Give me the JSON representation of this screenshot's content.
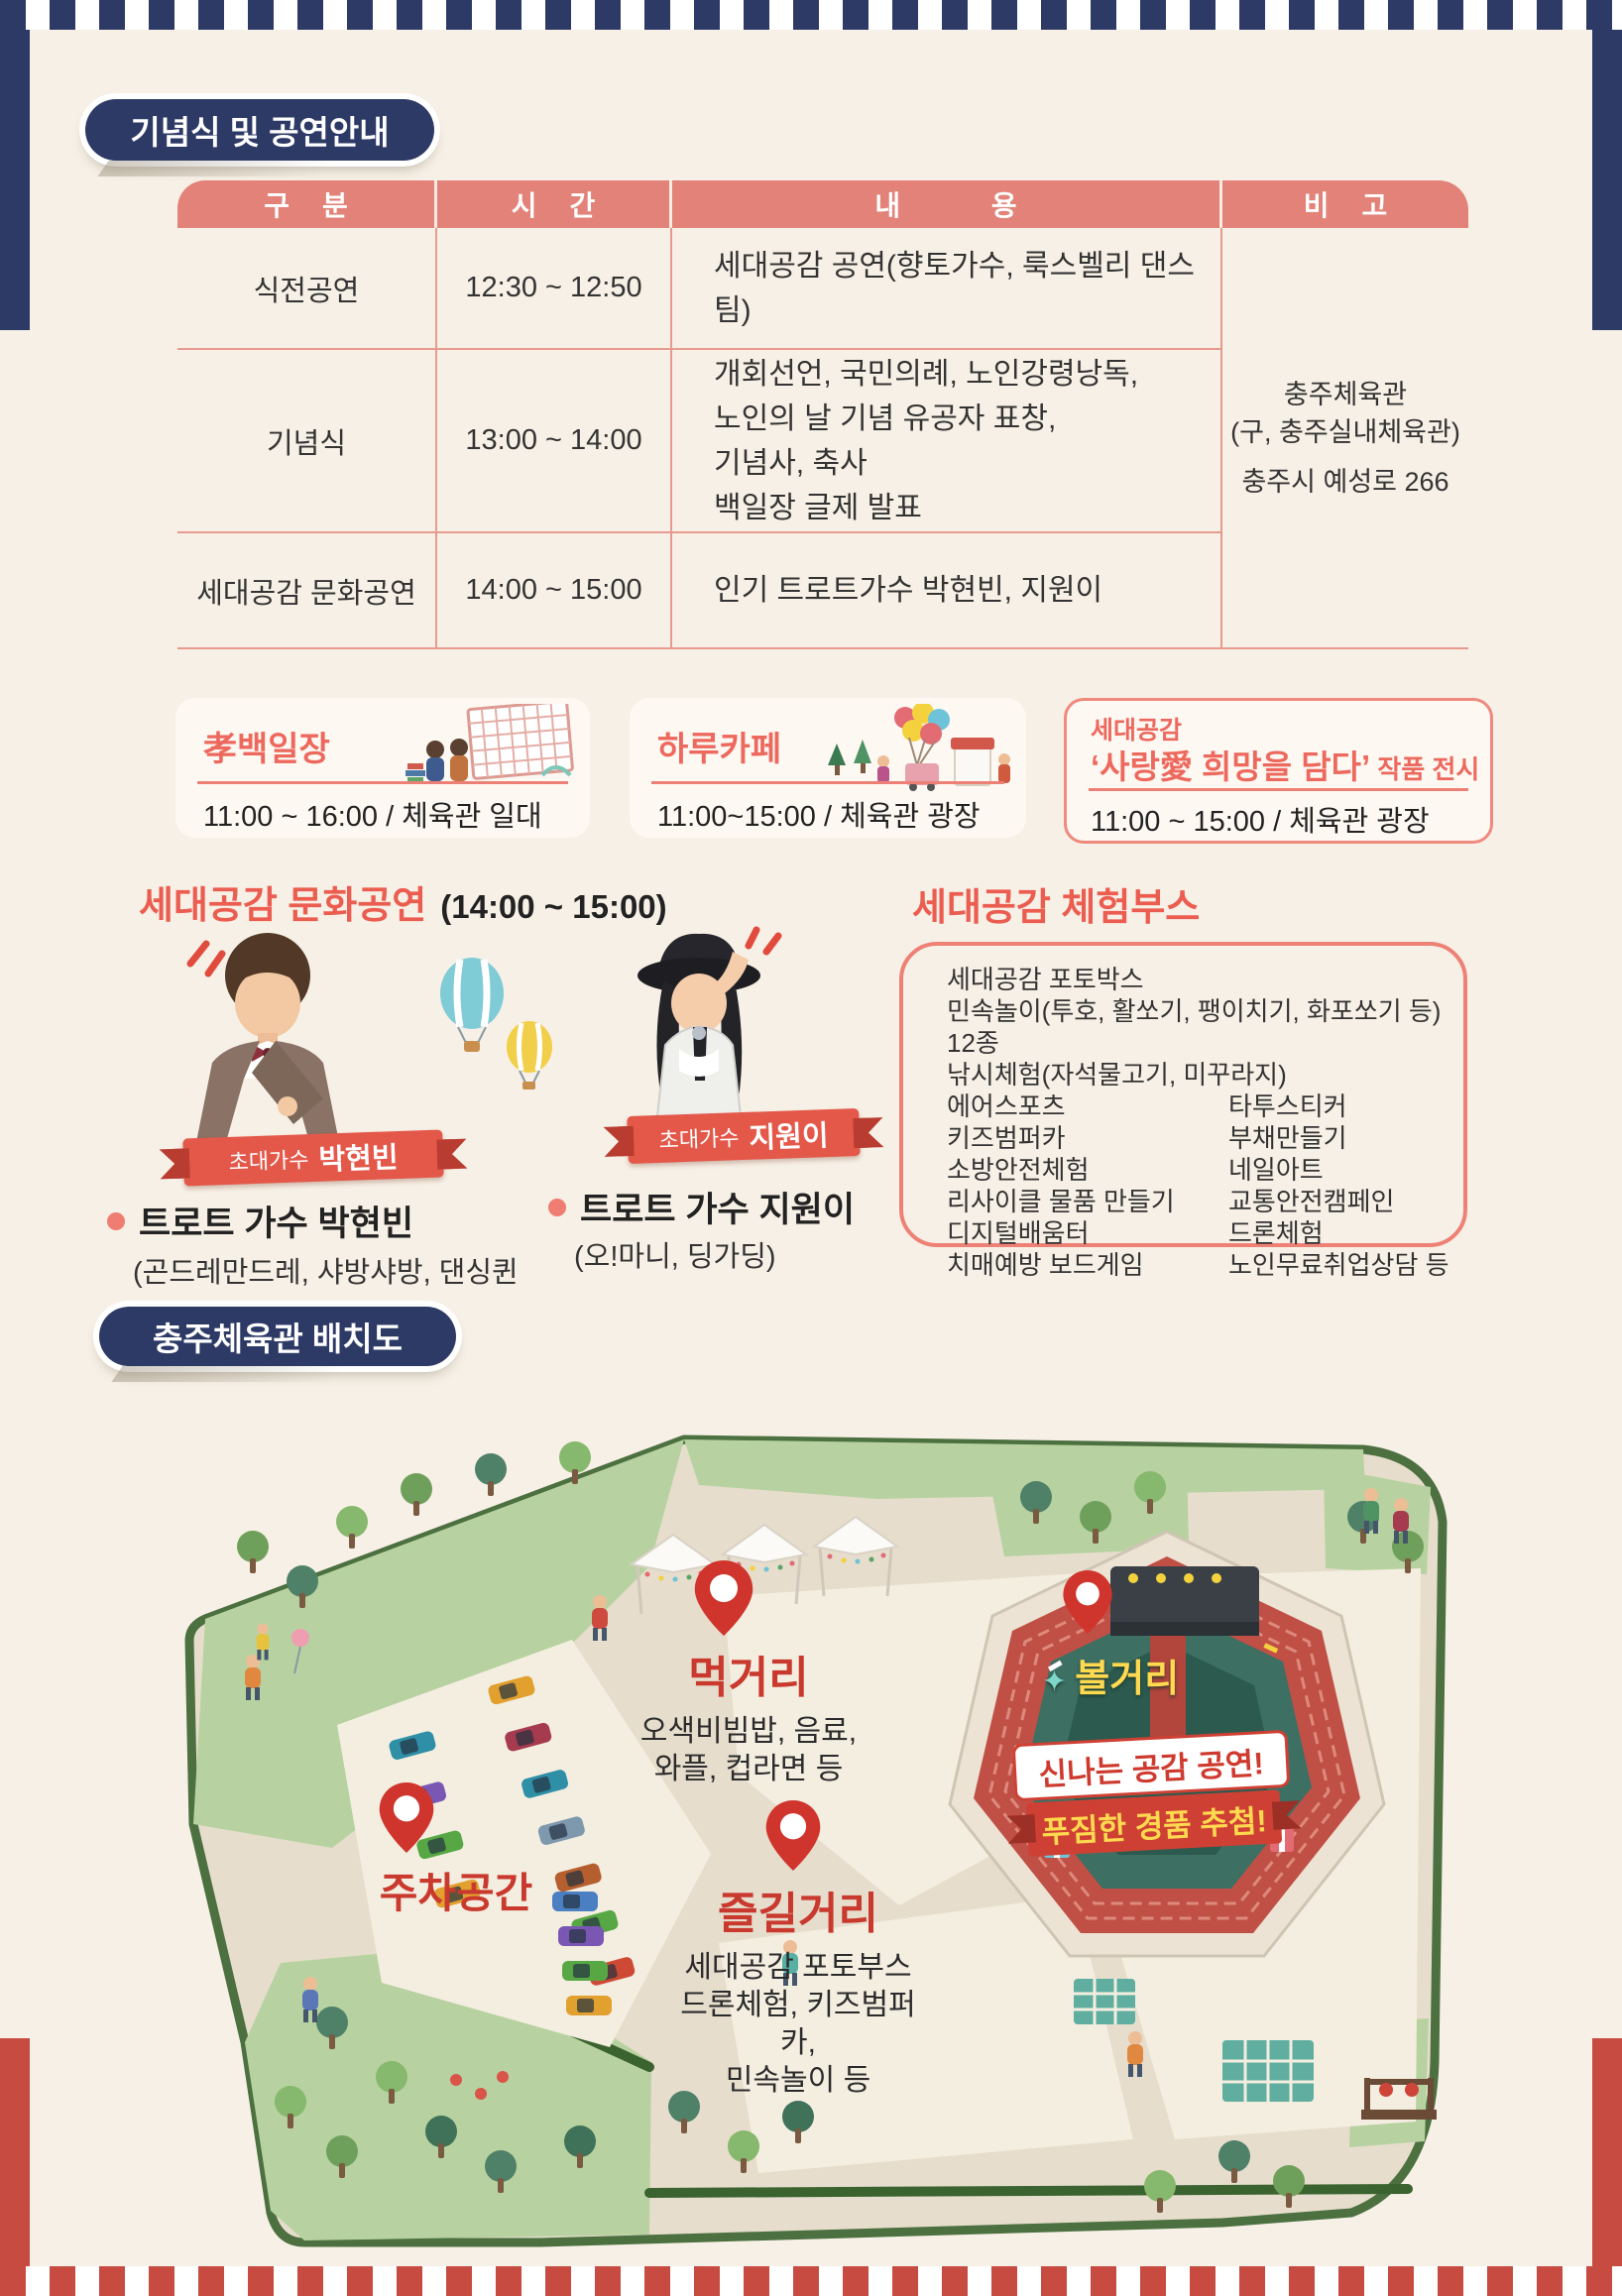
{
  "badges": {
    "ceremony": "기념식 및 공연안내",
    "map": "충주체육관 배치도"
  },
  "table": {
    "headers": {
      "category": "구 분",
      "time": "시 간",
      "content": "내 용",
      "note": "비 고"
    },
    "rows": [
      {
        "category": "식전공연",
        "time": "12:30 ~ 12:50",
        "content": "세대공감 공연(향토가수, 룩스벨리 댄스팀)"
      },
      {
        "category": "기념식",
        "time": "13:00 ~ 14:00",
        "content": "개회선언, 국민의례, 노인강령낭독,\n노인의 날 기념 유공자 표창,\n기념사, 축사\n백일장 글제 발표"
      },
      {
        "category": "세대공감 문화공연",
        "time": "14:00 ~ 15:00",
        "content": "인기 트로트가수 박현빈, 지원이"
      }
    ],
    "note": {
      "venue": "충주체육관\n(구, 충주실내체육관)",
      "address": "충주시 예성로 266"
    }
  },
  "cards": [
    {
      "title": "孝백일장",
      "time": "11:00 ~ 16:00 / 체육관 일대"
    },
    {
      "title": "하루카페",
      "time": "11:00~15:00 / 체육관 광장"
    },
    {
      "subtitle": "세대공감",
      "title": "‘사랑愛 희망을 담다’",
      "title_suffix": " 작품 전시",
      "time": "11:00 ~ 15:00 / 체육관 광장"
    }
  ],
  "performance": {
    "title": "세대공감 문화공연",
    "time": "(14:00 ~ 15:00)",
    "singers": [
      {
        "ribbon": "초대가수",
        "ribbon_name": "박현빈",
        "name": "트로트 가수 박현빈",
        "songs": "(곤드레만드레, 샤방샤방, 댄싱퀸 등)"
      },
      {
        "ribbon": "초대가수",
        "ribbon_name": "지원이",
        "name": "트로트 가수 지원이",
        "songs": "(오!마니, 딩가딩)"
      }
    ]
  },
  "booth": {
    "title": "세대공감 체험부스",
    "lines": [
      "세대공감 포토박스",
      "민속놀이(투호, 활쏘기, 팽이치기, 화포쏘기 등) 12종",
      "낚시체험(자석물고기, 미꾸라지)"
    ],
    "left": [
      "에어스포츠",
      "키즈범퍼카",
      "소방안전체험",
      "리사이클 물품 만들기",
      "디지털배움터",
      "치매예방 보드게임"
    ],
    "right": [
      "타투스티커",
      "부채만들기",
      "네일아트",
      "교통안전캠페인",
      "드론체험",
      "노인무료취업상담 등"
    ]
  },
  "map": {
    "food": {
      "label": "먹거리",
      "desc": "오색비빔밥, 음료,\n와플, 컵라면 등"
    },
    "parking": {
      "label": "주차공간"
    },
    "fun": {
      "label": "즐길거리",
      "desc": "세대공감 포토부스\n드론체험, 키즈범퍼카,\n민속놀이 등"
    },
    "show": {
      "label": "볼거리"
    },
    "banner1": "신나는 공감 공연!",
    "banner2": "푸짐한 경품 추첨!"
  },
  "colors": {
    "navy": "#2d3a66",
    "table_header": "#e28279",
    "coral_text": "#eb5d50",
    "map_red": "#c9392e",
    "cream": "#f7f0e6",
    "bottom_red": "#c74b41"
  }
}
